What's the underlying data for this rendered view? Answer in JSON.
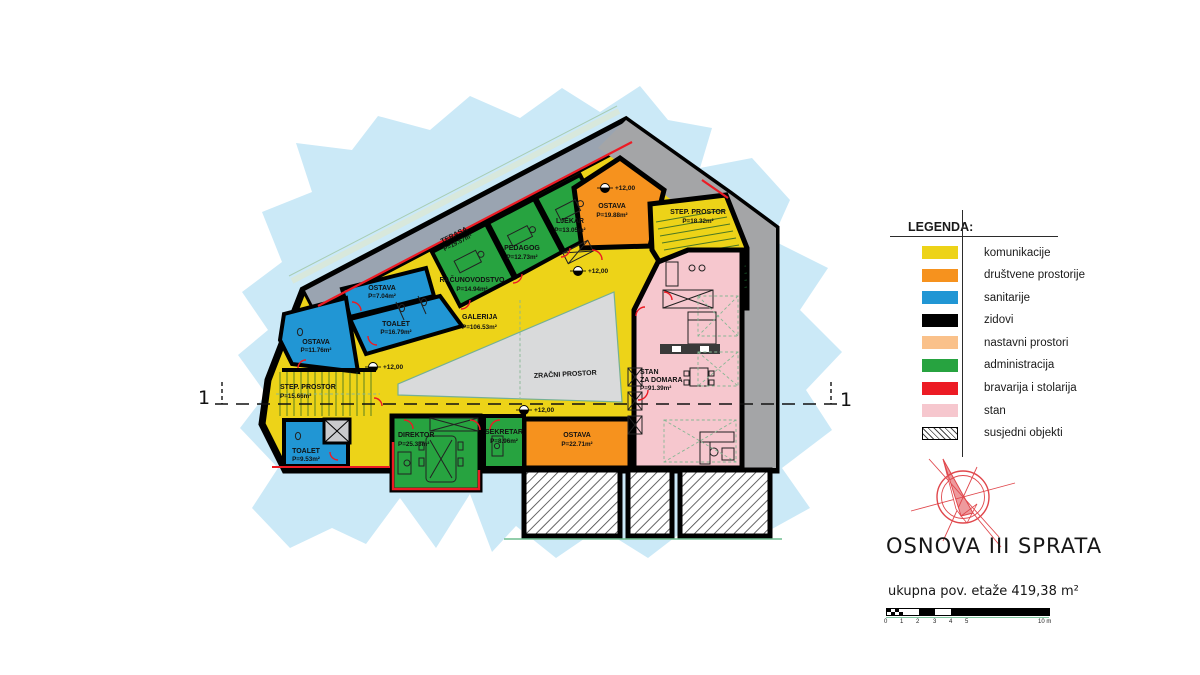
{
  "plan": {
    "section_label": "1",
    "level_value": "+12,00",
    "rooms": {
      "terasa": {
        "name": "TERASA",
        "area": "P=19.57m²"
      },
      "ostava7": {
        "name": "OSTAVA",
        "area": "P=7.04m²"
      },
      "toalet16": {
        "name": "TOALET",
        "area": "P=16.79m²"
      },
      "ostava11": {
        "name": "OSTAVA",
        "area": "P=11.76m²"
      },
      "step15": {
        "name": "STEP. PROSTOR",
        "area": "P=15.66m²"
      },
      "toalet9": {
        "name": "TOALET",
        "area": "P=9.53m²"
      },
      "racunovodstvo": {
        "name": "RAČUNOVODSTVO",
        "area": "P=14.94m²"
      },
      "pedagog": {
        "name": "PEDAGOG",
        "area": "P=12.73m²"
      },
      "ljekar": {
        "name": "LJEKAR",
        "area": "P=13.05m²"
      },
      "ostava19": {
        "name": "OSTAVA",
        "area": "P=19.88m²"
      },
      "step18": {
        "name": "STEP. PROSTOR",
        "area": "P=18.32m²"
      },
      "galerija": {
        "name": "GALERIJA",
        "area": "P=106.53m²"
      },
      "zracni": {
        "name": "ZRAČNI PROSTOR"
      },
      "direktor": {
        "name": "DIREKTOR",
        "area": "P=25.33m²"
      },
      "sekretar": {
        "name": "SEKRETAR",
        "area": "P=8.96m²"
      },
      "ostava22": {
        "name": "OSTAVA",
        "area": "P=22.71m²"
      },
      "stan": {
        "name1": "STAN",
        "name2": "ZA DOMARA",
        "area": "P=91.39m²"
      }
    }
  },
  "legend": {
    "title": "LEGENDA:",
    "items": [
      {
        "label": "komunikacije",
        "color_key": "komunikacije"
      },
      {
        "label": "društvene prostorije",
        "color_key": "drustvene"
      },
      {
        "label": "sanitarije",
        "color_key": "sanitarije"
      },
      {
        "label": "zidovi",
        "color_key": "zidovi"
      },
      {
        "label": "nastavni prostori",
        "color_key": "nastavni"
      },
      {
        "label": "administracija",
        "color_key": "administracija"
      },
      {
        "label": "bravarija i stolarija",
        "color_key": "bravarija"
      },
      {
        "label": "stan",
        "color_key": "stan"
      },
      {
        "label": "susjedni objekti",
        "color_key": "hatch"
      }
    ]
  },
  "title_block": {
    "title": "OSNOVA III SPRATA",
    "subtitle": "ukupna pov. etaže 419,38 m²"
  },
  "scale_bar": {
    "ticks": [
      "0",
      "1",
      "2",
      "3",
      "4",
      "5"
    ],
    "end_label": "10 m"
  },
  "colors": {
    "komunikacije": "#EDD318",
    "drustvene": "#F6921E",
    "sanitarije": "#2196D4",
    "zidovi": "#000000",
    "nastavni": "#FAC18A",
    "administracija": "#27A340",
    "bravarija": "#EC1B24",
    "stan": "#F6C7CE",
    "site_blob": "#CBE9F7",
    "terrace_band": "#9AA4B1",
    "adjacent_gray": "#A4A5A7",
    "void_gray": "#D9DADB",
    "ground_line": "#6FBD8F"
  }
}
